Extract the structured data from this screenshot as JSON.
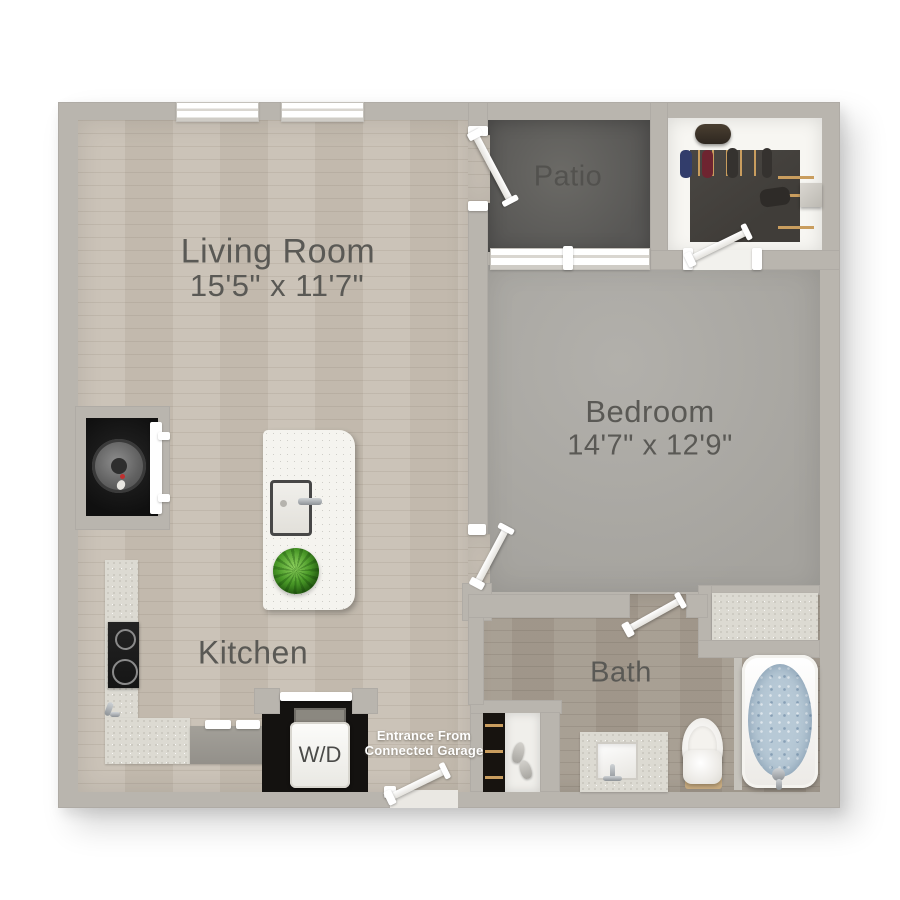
{
  "rooms": {
    "living": {
      "label": "Living Room",
      "dims": "15'5\" x 11'7\""
    },
    "patio": {
      "label": "Patio"
    },
    "bedroom": {
      "label": "Bedroom",
      "dims": "14'7\" x 12'9\""
    },
    "kitchen": {
      "label": "Kitchen"
    },
    "bath": {
      "label": "Bath"
    }
  },
  "laundry": {
    "label": "W/D"
  },
  "entrance_note": {
    "line1": "Entrance From",
    "line2": "Connected Garage"
  },
  "colors": {
    "wall": "#b9b5ae",
    "wood_floor": "#c8c0b4",
    "bath_floor": "#a59c90",
    "carpet": "#a5a39e",
    "patio_floor": "#585755",
    "closet_dark": "#403d39",
    "counter": "#dcdad2",
    "water": "#b7c9d6",
    "plant": "#4a9a28",
    "label_text": "#5a5955"
  }
}
